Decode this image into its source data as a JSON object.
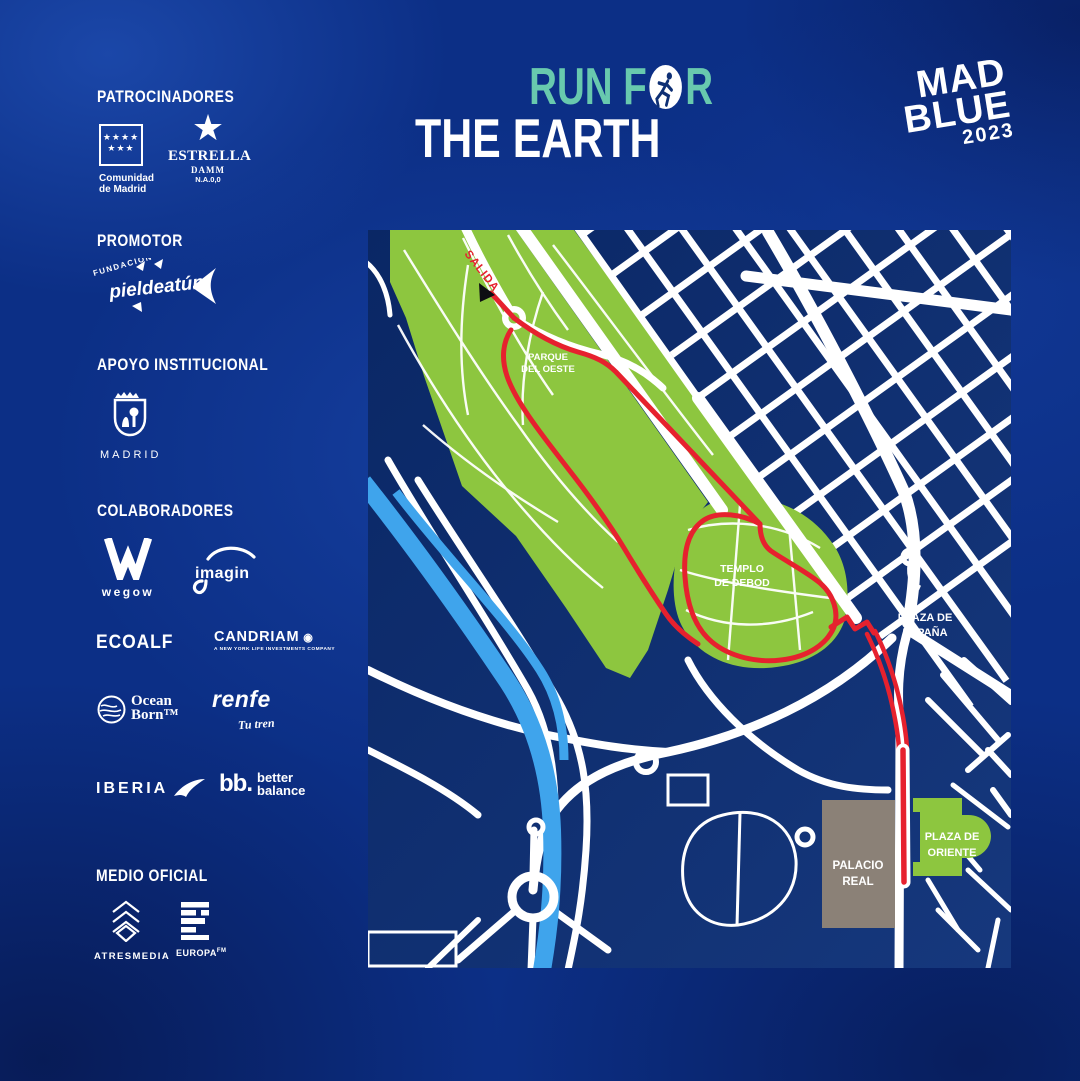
{
  "colors": {
    "posterBlue": "#0c2f86",
    "mapBg": "#0a2765",
    "mapBg2": "#16387d",
    "parkGreen": "#8dc63f",
    "riverBlue": "#3fa4ec",
    "routeRed": "#e6212e",
    "streetWhite": "#ffffff",
    "titleTeal": "#68c9ae",
    "buildingGray": "#8b8177",
    "arrowBlack": "#0d0d12"
  },
  "header": {
    "title_run": "RUN F",
    "title_r": "R",
    "title_earth": "THE EARTH"
  },
  "brand": {
    "mad": "MAD",
    "blue": "BLUE",
    "year": "2023"
  },
  "sidebar": {
    "patrocinadores": "PATROCINADORES",
    "promotor": "PROMOTOR",
    "apoyo": "APOYO INSTITUCIONAL",
    "colaboradores": "COLABORADORES",
    "medio": "MEDIO OFICIAL",
    "logos": {
      "comunidad": {
        "stars_row1": "★★★★",
        "stars_row2": "★★★",
        "caption1": "Comunidad",
        "caption2": "de Madrid"
      },
      "estrella": {
        "star": "★",
        "name": "ESTRELLA",
        "damm": "DAMM",
        "na": "N.A.0,0"
      },
      "fundacion": {
        "fundacion": "FUNDACIÓN",
        "script": "pieldeatún"
      },
      "madrid": {
        "caption": "MADRID"
      },
      "wegow": {
        "name": "wegow"
      },
      "imagin": {
        "name": "imagin"
      },
      "ecoalf": {
        "name": "ECOALF"
      },
      "candriam": {
        "name": "CANDRIAM",
        "tagline": "A NEW YORK LIFE INVESTMENTS COMPANY"
      },
      "oceanborn": {
        "line1": "Ocean",
        "line2": "Born™"
      },
      "renfe": {
        "name": "renfe",
        "tagline": "Tu tren"
      },
      "iberia": {
        "name": "IBERIA"
      },
      "betterbalance": {
        "bb": "bb.",
        "line1": "better",
        "line2": "balance"
      },
      "atresmedia": {
        "name": "ATRESMEDIA"
      },
      "europafm": {
        "name": "EUROPA",
        "fm": "FM"
      }
    }
  },
  "map": {
    "labels": {
      "salida": "SALIDA",
      "parque_oeste": [
        "PARQUE",
        "DEL OESTE"
      ],
      "templo_debod": [
        "TEMPLO",
        "DE DEBOD"
      ],
      "plaza_espana": [
        "PLAZA DE",
        "ESPAÑA"
      ],
      "palacio_real": [
        "PALACIO",
        "REAL"
      ],
      "plaza_oriente": [
        "PLAZA DE",
        "ORIENTE"
      ]
    }
  }
}
